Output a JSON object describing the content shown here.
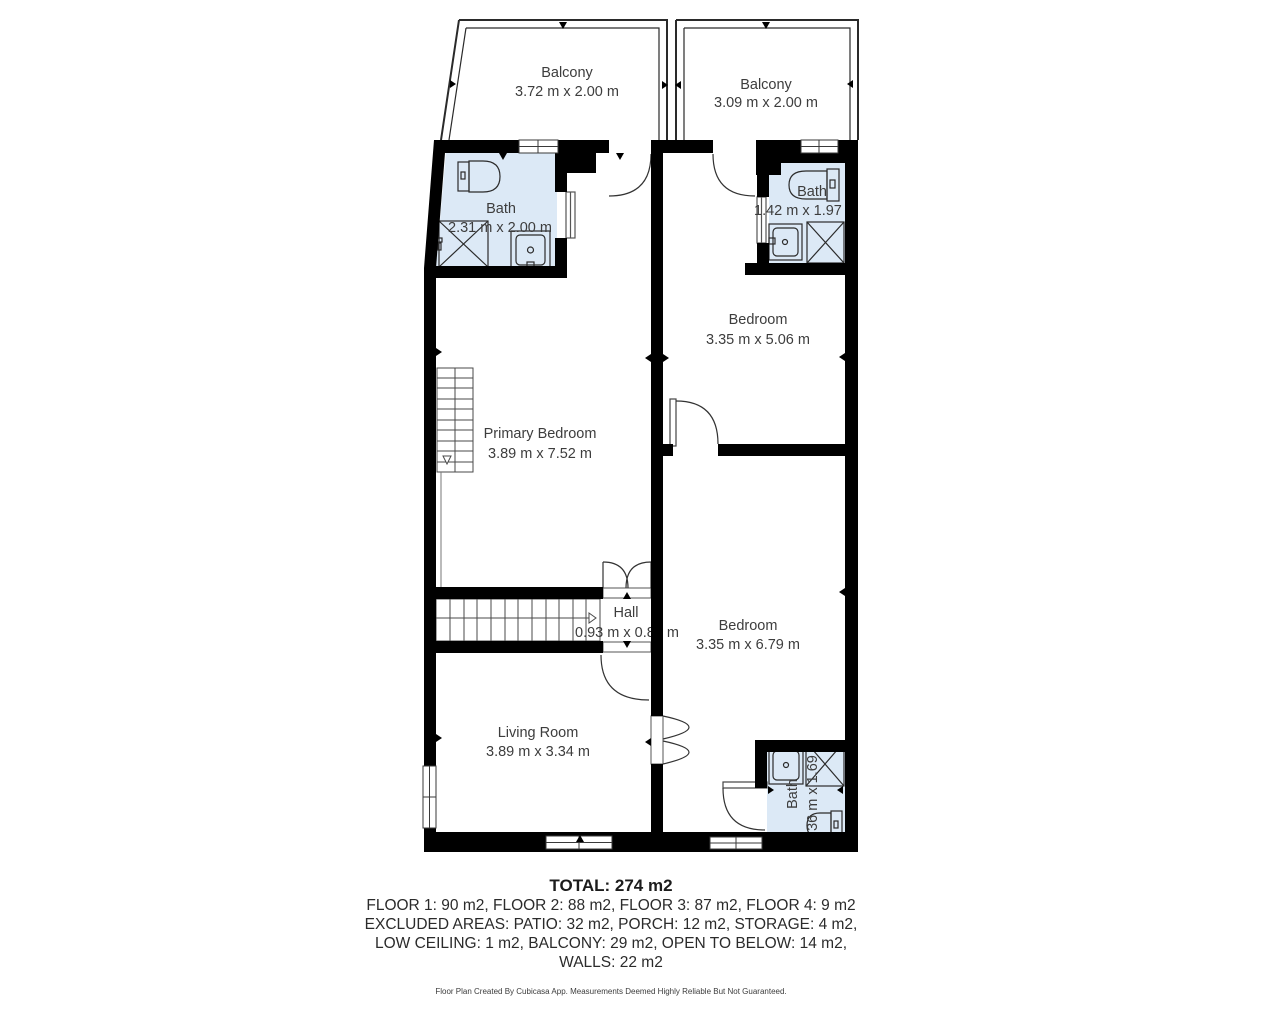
{
  "plan": {
    "colors": {
      "bath_fill": "#dce9f6",
      "wall": "#000000",
      "label_text": "#3d3d3d"
    },
    "rooms": [
      {
        "id": "balcony-left",
        "name": "Balcony",
        "dims": "3.72 m x 2.00 m"
      },
      {
        "id": "balcony-right",
        "name": "Balcony",
        "dims": "3.09 m x 2.00 m"
      },
      {
        "id": "bath-top-left",
        "name": "Bath",
        "dims": "2.31 m x 2.00 m"
      },
      {
        "id": "bath-top-right",
        "name": "Bath",
        "dims": "1.42 m x 1.97 m"
      },
      {
        "id": "bedroom-upper",
        "name": "Bedroom",
        "dims": "3.35 m x 5.06 m"
      },
      {
        "id": "primary-bedroom",
        "name": "Primary Bedroom",
        "dims": "3.89 m x 7.52 m"
      },
      {
        "id": "hall",
        "name": "Hall",
        "dims": "0.93 m x 0.89 m"
      },
      {
        "id": "bedroom-lower",
        "name": "Bedroom",
        "dims": "3.35 m x 6.79 m"
      },
      {
        "id": "living-room",
        "name": "Living Room",
        "dims": "3.89 m x 3.34 m"
      },
      {
        "id": "bath-bottom",
        "name": "Bath",
        "dims": "1.36 m x 1.69 m"
      }
    ]
  },
  "summary": {
    "total": "TOTAL: 274 m2",
    "line1": "FLOOR 1: 90 m2, FLOOR 2: 88 m2, FLOOR 3: 87 m2, FLOOR 4: 9 m2",
    "line2": "EXCLUDED AREAS: PATIO: 32 m2, PORCH: 12 m2, STORAGE: 4 m2,",
    "line3": "LOW CEILING: 1 m2, BALCONY: 29 m2, OPEN TO BELOW: 14 m2,",
    "line4": "WALLS: 22 m2"
  },
  "footer": {
    "note": "Floor Plan Created By Cubicasa App. Measurements Deemed Highly Reliable But Not Guaranteed."
  }
}
